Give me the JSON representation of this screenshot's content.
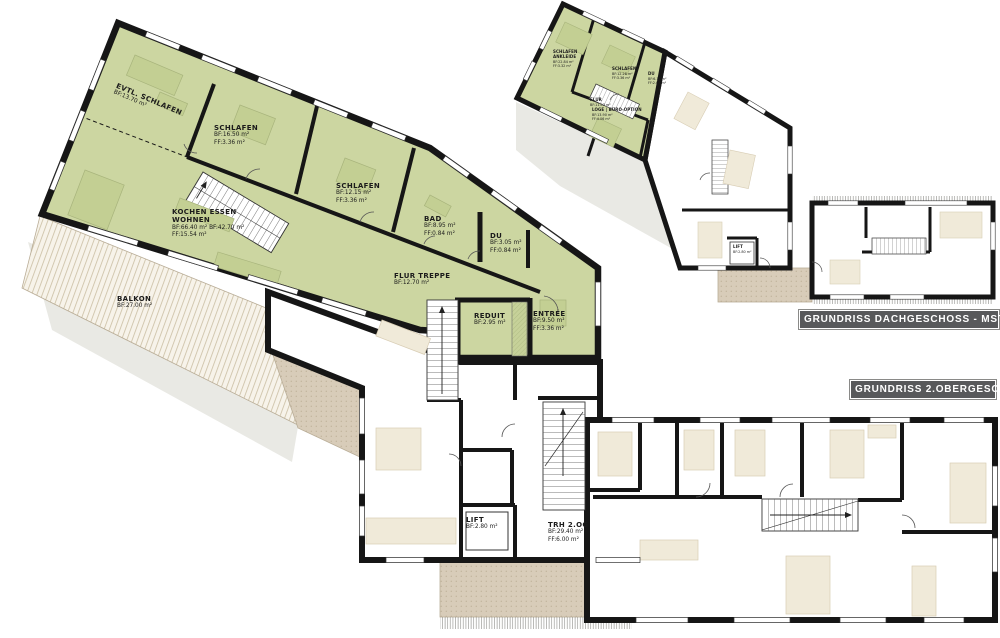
{
  "titles": {
    "dachgeschoss": "GRUNDRISS  DACHGESCHOSS  -  MST.  1:200",
    "obergeschoss": "GRUNDRISS  2.OBERGESCHOSS"
  },
  "floor_2og": {
    "rooms": [
      {
        "label": "EVTL. SCHLAFEN",
        "l1": "BF:13.70 m²"
      },
      {
        "label": "SCHLAFEN",
        "l1": "BF:16.50 m²",
        "l2": "FF:3.36  m²"
      },
      {
        "label": "SCHLAFEN",
        "l1": "BF:12.15 m²",
        "l2": "FF:3.36  m²"
      },
      {
        "label": "KOCHEN ESSEN",
        "label2": "WOHNEN",
        "l1": "BF:66.40 m²   BF:42.70 m²",
        "l2": "FF:15.54 m²"
      },
      {
        "label": "BAD",
        "l1": "BF:8.95  m²",
        "l2": "FF:0.84  m²"
      },
      {
        "label": "DU",
        "l1": "BF:3.05  m²",
        "l2": "FF:0.84  m²"
      },
      {
        "label": "FLUR TREPPE",
        "l1": "BF:12.70 m²"
      },
      {
        "label": "BALKON",
        "l1": "BF:27.00 m²"
      },
      {
        "label": "REDUIT",
        "l1": "BF:2.95  m²"
      },
      {
        "label": "ENTRÉE",
        "l1": "BF:9.50  m²",
        "l2": "FF:3.36  m²"
      },
      {
        "label": "LIFT",
        "l1": "BF:2.80  m²"
      },
      {
        "label": "TRH 2.OG",
        "l1": "BF:29.40 m²",
        "l2": "FF:6.00  m²"
      }
    ]
  },
  "floor_dg": {
    "rooms": [
      {
        "label": "SCHLAFEN",
        "label2": "ANKLEIDE",
        "l1": "BF:22.84 m²",
        "l2": "FF:3.32 m²"
      },
      {
        "label": "SCHLAFEN",
        "l1": "BF:12.28 m²",
        "l2": "FF:3.36 m²"
      },
      {
        "label": "FLUR",
        "l1": "BF:11.03 m²"
      },
      {
        "label": "DU",
        "l1": "BF:6.11 m²",
        "l2": "FF:2.08 m²"
      },
      {
        "label": "LOGE | BÜRO-OPTION",
        "l1": "BF:13.90 m²",
        "l2": "FF:4.06 m²"
      },
      {
        "label": "LIFT",
        "l1": "BF:2.80 m²"
      }
    ]
  },
  "colors": {
    "room_green": "#ccd6a1",
    "wall": "#161616",
    "terrace": "#d8ccb9",
    "furniture": "#f0ead9",
    "shadow": "#e9e9e4",
    "title_bg": "#58595b",
    "title_text": "#ffffff"
  }
}
